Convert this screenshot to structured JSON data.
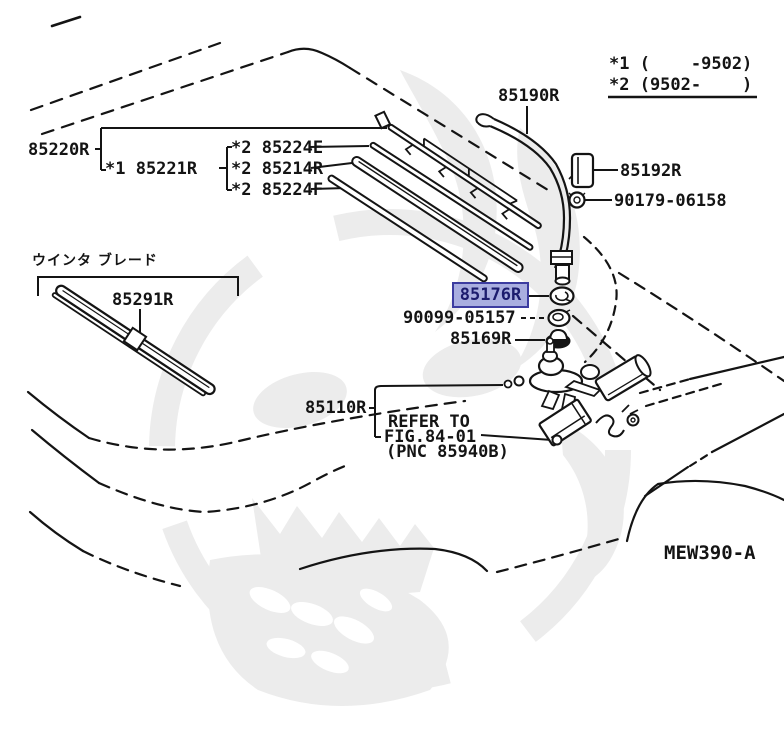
{
  "diagram": {
    "code": "MEW390-A",
    "notes": {
      "note1": "*1 (    -9502)",
      "note2": "*2 (9502-    )"
    },
    "captions": {
      "winter_blade_jp": "ウインタ ブレード"
    },
    "labels": {
      "l85220R": "85220R",
      "l85221R": "*1 85221R",
      "l85224E": "*2 85224E",
      "l85214R": "*2 85214R",
      "l85224F": "*2 85224F",
      "l85190R": "85190R",
      "l85192R": "85192R",
      "l9017906158": "90179-06158",
      "l85176R": "85176R",
      "l9009905157": "90099-05157",
      "l85169R": "85169R",
      "l85291R": "85291R",
      "l85110R": "85110R",
      "refer_line1": "REFER TO",
      "refer_line2": "FIG.84-01",
      "refer_line3": "(PNC 85940B)"
    },
    "highlight": {
      "part": "85176R",
      "fill": "#a9aee0",
      "border": "#3c3ca0",
      "text_color": "#1c1c6e"
    },
    "colors": {
      "line": "#141414",
      "background": "#ffffff",
      "watermark": "#ececec"
    }
  }
}
